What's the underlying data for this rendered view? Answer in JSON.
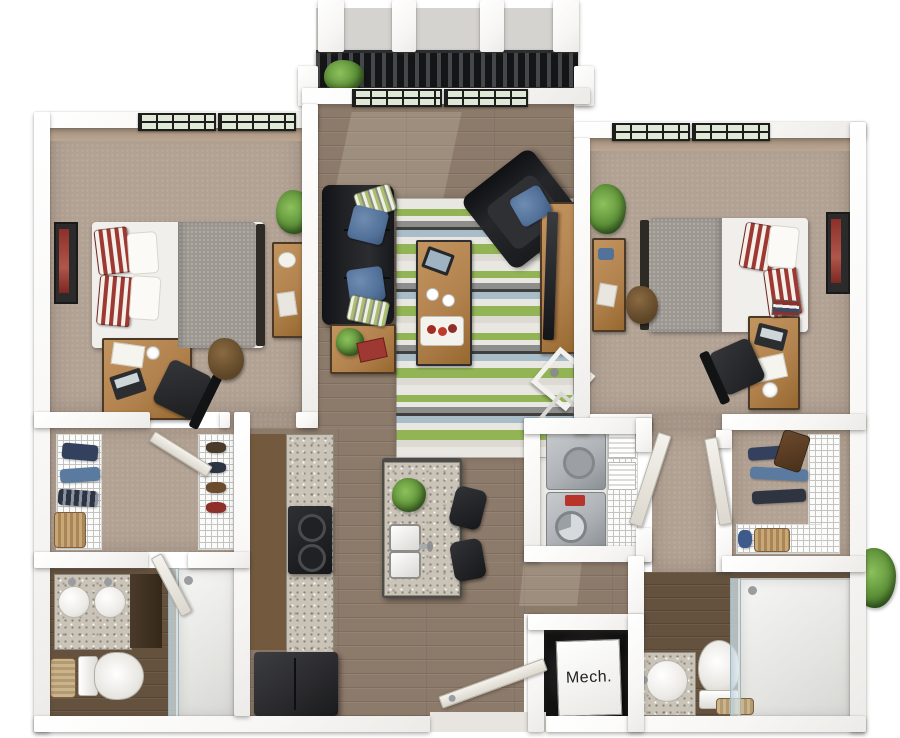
{
  "labels": {
    "mech_room": "Mech."
  },
  "colors": {
    "background": "#ffffff",
    "wall": "#f7f6f4",
    "wood_floor": "#8c7a6a",
    "wood_floor_dark": "#64523f",
    "carpet": "#b2a294",
    "accent_wall": "#a5907c",
    "granite": "#cac3b8",
    "cabinet_brown": "#735a3e",
    "furniture_wood": "#b2824e",
    "sofa_black": "#202124",
    "appliance_black": "#2b2b2e",
    "washer_gray": "#aeb2b6",
    "rug_green": "#93b455",
    "rug_blue": "#a9bdc9",
    "pillow_blue": "#53729a",
    "accent_red": "#9e3832",
    "blanket_gray": "#9d9892",
    "linen_white": "#f1efec",
    "plant_green": "#5d9038",
    "railing_black": "#232426",
    "glass": "#cfdbe0"
  }
}
